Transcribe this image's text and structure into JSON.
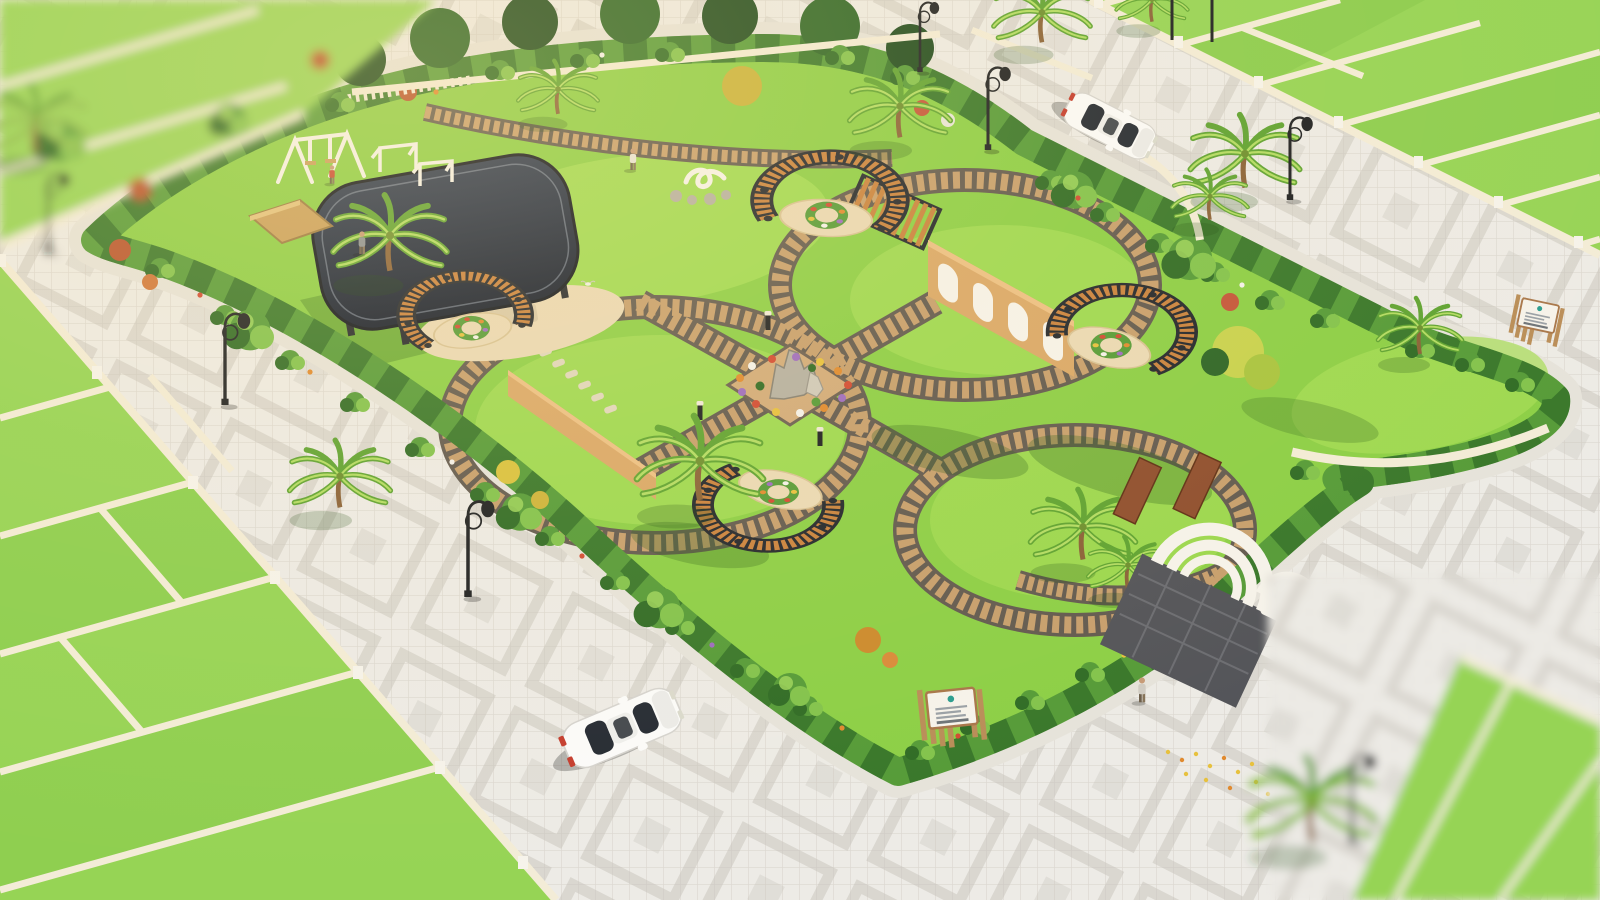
{
  "scene": {
    "title": "Aerial 3D architectural rendering of a plotted residential development wrapped around a central landscaped park",
    "view": "isometric aerial, golden-hour sunlight, depth-of-field blur at image corners",
    "no_visible_text": true
  },
  "park": {
    "label": "central community park",
    "lawn_areas": 4,
    "features": [
      {
        "name": "playground",
        "items": [
          "swing-set",
          "football-goals",
          "child-figure"
        ]
      },
      {
        "name": "gazebo",
        "roof": "rounded dark-slate canopy on black posts"
      },
      {
        "name": "crescent-pergolas",
        "count": 4,
        "material": "orange wood slats on dark steel"
      },
      {
        "name": "wood-slat-shelter",
        "count": 1
      },
      {
        "name": "arched-feature-wall",
        "niches": 4
      },
      {
        "name": "central-rock-garden",
        "flower_colors": [
          "#d24a33",
          "#e08a2f",
          "#9d6bc0",
          "#f4f2ec",
          "#e7c13e"
        ]
      },
      {
        "name": "entrance-gateway",
        "nested_arches": 3,
        "side_panels": "corten brown"
      },
      {
        "name": "swan-topiary-sculpture"
      },
      {
        "name": "stepping-stone-path"
      },
      {
        "name": "sign-boards",
        "count": 2,
        "logo_color": "#2a9d8f",
        "text": "illegible at this scale"
      }
    ]
  },
  "surroundings": {
    "plots": {
      "left_rows": 6,
      "top_right_strips": 7,
      "corner_clusters_blurred": 2
    },
    "roads": {
      "paving": "white-grey interlocking pavers with grey diamond motifs"
    },
    "vehicles": [
      {
        "type": "coupe",
        "color": "white",
        "location": "south road"
      },
      {
        "type": "sedan",
        "color": "white",
        "location": "north-east road"
      }
    ],
    "street_lamps": 9,
    "bollard_lights": 3,
    "palm_trees": 14,
    "people": 3,
    "birds_on_lawn": 5,
    "fallen_yellow_leaves": "on south-east sidewalk"
  },
  "colors": {
    "roadBase": "#edebe6",
    "roadGrid": "#dcd8d1",
    "roadMotif": "#c6c2ba",
    "plotGrass": "#96d455",
    "plotGrassDeep": "#7dc344",
    "wallCream": "#f3ecd7",
    "wallShade": "#d5c9a6",
    "parkLawn": "#8ccf46",
    "parkLawnLight": "#a5dd55",
    "hedgeDark": "#2f6b25",
    "hedgeMid": "#559b38",
    "bushLight": "#82c34c",
    "pathBrick": "#c79f6d",
    "pathEdge": "#625a50",
    "pathLight": "#ead9b5",
    "sandWall": "#daa868",
    "roofDark": "#2b3850",
    "roofDeep": "#151d2d",
    "frameDark": "#23272d",
    "woodSlat": "#c9823e",
    "whiteStruct": "#f6f3eb",
    "carWhite": "#fbfbfa",
    "glassDark": "#242a33",
    "darkPave": "#535459",
    "lampBlack": "#1e2023",
    "teal": "#2a9d8f",
    "flowerRed": "#d24a33",
    "flowerOrange": "#e08a2f",
    "flowerYellow": "#e7c13e",
    "flowerPurple": "#9d6bc0",
    "flowerWhite": "#f4f2ec",
    "trunkBrown": "#8a6238",
    "topTreeDark": "#1e4a1e",
    "topTreeMid": "#2c6526",
    "accentRust": "#b8542e",
    "accentAmber": "#cc8a2d"
  }
}
